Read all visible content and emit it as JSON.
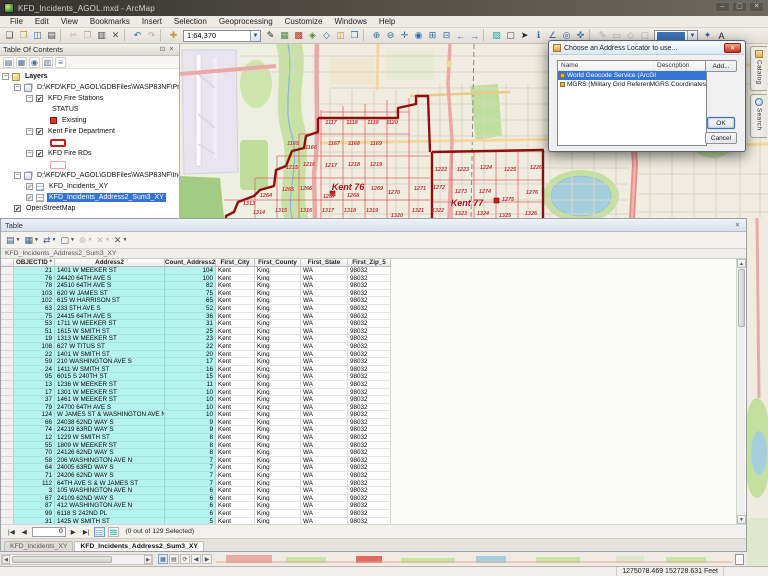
{
  "window": {
    "title": "KFD_Incidents_AGOL.mxd - ArcMap"
  },
  "menu": {
    "items": [
      "File",
      "Edit",
      "View",
      "Bookmarks",
      "Insert",
      "Selection",
      "Geoprocessing",
      "Customize",
      "Windows",
      "Help"
    ]
  },
  "toolbar": {
    "scale": "1:64,370",
    "icons1": [
      {
        "n": "new-map-icon",
        "g": "❏"
      },
      {
        "n": "open-map-icon",
        "g": "❒",
        "c": "y"
      },
      {
        "n": "save-icon",
        "g": "◫",
        "c": "b"
      },
      {
        "n": "print-icon",
        "g": "▤"
      },
      {
        "n": "sep",
        "sep": true
      },
      {
        "n": "cut-icon",
        "g": "✂",
        "c": "x"
      },
      {
        "n": "copy-icon",
        "g": "❐",
        "c": "x"
      },
      {
        "n": "paste-icon",
        "g": "▥"
      },
      {
        "n": "delete-icon",
        "g": "✕"
      },
      {
        "n": "sep",
        "sep": true
      },
      {
        "n": "undo-icon",
        "g": "↶",
        "c": "b"
      },
      {
        "n": "redo-icon",
        "g": "↷",
        "c": "x"
      },
      {
        "n": "sep",
        "sep": true
      },
      {
        "n": "add-data-icon",
        "g": "✚",
        "c": "y"
      }
    ],
    "icons2": [
      {
        "n": "editor-toolbar-icon",
        "g": "✎",
        "c": "k"
      },
      {
        "n": "table-window-icon",
        "g": "▦",
        "c": "g"
      },
      {
        "n": "arctoolbox-icon",
        "g": "▩",
        "c": "r"
      },
      {
        "n": "model-builder-icon",
        "g": "◈",
        "c": "g"
      },
      {
        "n": "python-window-icon",
        "g": "◇",
        "c": "b"
      },
      {
        "n": "catalog-window-icon",
        "g": "◫",
        "c": "y"
      },
      {
        "n": "search-window-icon",
        "g": "❒",
        "c": "b"
      },
      {
        "n": "sep",
        "sep": true
      },
      {
        "n": "zoom-in-icon",
        "g": "⊕",
        "c": "b"
      },
      {
        "n": "zoom-out-icon",
        "g": "⊖",
        "c": "b"
      },
      {
        "n": "pan-icon",
        "g": "✛",
        "c": "b",
        "sel": true
      },
      {
        "n": "full-extent-icon",
        "g": "◉",
        "c": "b"
      },
      {
        "n": "fixed-zoom-in-icon",
        "g": "⊞",
        "c": "b"
      },
      {
        "n": "fixed-zoom-out-icon",
        "g": "⊟",
        "c": "b"
      },
      {
        "n": "go-back-extent-icon",
        "g": "←",
        "c": "b"
      },
      {
        "n": "go-forward-extent-icon",
        "g": "→",
        "c": "b"
      },
      {
        "n": "sep",
        "sep": true
      },
      {
        "n": "select-features-icon",
        "g": "▧",
        "c": "c"
      },
      {
        "n": "clear-selection-icon",
        "g": "▢"
      },
      {
        "n": "select-elements-icon",
        "g": "➤",
        "c": "k"
      },
      {
        "n": "identify-icon",
        "g": "ℹ",
        "c": "b"
      },
      {
        "n": "measure-icon",
        "g": "∠",
        "c": "b"
      },
      {
        "n": "find-icon",
        "g": "◎",
        "c": "b"
      },
      {
        "n": "go-to-xy-icon",
        "g": "✜",
        "c": "b"
      }
    ],
    "icons3": [
      {
        "n": "edit-vertices-icon",
        "g": "✎",
        "c": "x"
      },
      {
        "n": "sketch-properties-icon",
        "g": "▭",
        "c": "x"
      },
      {
        "n": "create-features-icon",
        "g": "◇",
        "c": "x"
      },
      {
        "n": "attributes-icon",
        "g": "▢",
        "c": "x"
      }
    ],
    "icons4": [
      {
        "n": "snapping-icon",
        "g": "✦",
        "c": "b"
      },
      {
        "n": "labeling-icon",
        "g": "A",
        "c": "k"
      }
    ]
  },
  "toc": {
    "title": "Table Of Contents",
    "tools": [
      {
        "n": "list-by-drawing-order-icon",
        "g": "▤"
      },
      {
        "n": "list-by-source-icon",
        "g": "▦"
      },
      {
        "n": "list-by-visibility-icon",
        "g": "◉"
      },
      {
        "n": "list-by-selection-icon",
        "g": "▥"
      },
      {
        "n": "toc-options-icon",
        "g": "≡"
      }
    ],
    "rows": [
      {
        "indent": 0,
        "exp": true,
        "icon": "layers",
        "label": "Layers",
        "bold": true
      },
      {
        "indent": 1,
        "exp": true,
        "icon": "group",
        "label": "D:\\KFD\\KFD_AGOL\\GDBFiles\\WASP83NF\\Protecti"
      },
      {
        "indent": 2,
        "exp": true,
        "check": "on",
        "label": "KFD Fire Stations"
      },
      {
        "indent": 4,
        "label": "STATUS"
      },
      {
        "indent": 4,
        "sym": "point",
        "label": "Existing"
      },
      {
        "indent": 2,
        "exp": true,
        "check": "on",
        "label": "Kent Fire Department"
      },
      {
        "indent": 4,
        "sym": "poly-red",
        "label": ""
      },
      {
        "indent": 2,
        "exp": true,
        "check": "on",
        "label": "KFD Fire RDs"
      },
      {
        "indent": 4,
        "sym": "poly-pink",
        "label": ""
      },
      {
        "indent": 1,
        "exp": true,
        "icon": "group",
        "label": "D:\\KFD\\KFD_AGOL\\GDBFiles\\WASP83NF\\Incident"
      },
      {
        "indent": 2,
        "check": "gray",
        "icon": "tbl",
        "label": "KFD_Incidents_XY"
      },
      {
        "indent": 2,
        "check": "gray",
        "icon": "tbl",
        "label": "KFD_Incidents_Address2_Sum3_XY",
        "sel": true
      },
      {
        "indent": 1,
        "check": "on",
        "label": "OpenStreetMap"
      }
    ]
  },
  "map": {
    "labels": [
      {
        "t": "1117",
        "x": 151,
        "y": 79
      },
      {
        "t": "1118",
        "x": 172,
        "y": 79
      },
      {
        "t": "1119",
        "x": 193,
        "y": 79
      },
      {
        "t": "1120",
        "x": 212,
        "y": 79
      },
      {
        "t": "1165",
        "x": 113,
        "y": 100
      },
      {
        "t": "1166",
        "x": 131,
        "y": 104
      },
      {
        "t": "1167",
        "x": 154,
        "y": 100
      },
      {
        "t": "1168",
        "x": 174,
        "y": 100
      },
      {
        "t": "1169",
        "x": 196,
        "y": 100
      },
      {
        "t": "1215",
        "x": 112,
        "y": 124
      },
      {
        "t": "1216",
        "x": 129,
        "y": 121
      },
      {
        "t": "1217",
        "x": 151,
        "y": 122
      },
      {
        "t": "1218",
        "x": 174,
        "y": 121
      },
      {
        "t": "1219",
        "x": 196,
        "y": 121
      },
      {
        "t": "1222",
        "x": 261,
        "y": 126
      },
      {
        "t": "1223",
        "x": 283,
        "y": 126
      },
      {
        "t": "1224",
        "x": 306,
        "y": 124
      },
      {
        "t": "1225",
        "x": 330,
        "y": 126
      },
      {
        "t": "1226",
        "x": 356,
        "y": 124
      },
      {
        "t": "1264",
        "x": 86,
        "y": 152
      },
      {
        "t": "1265",
        "x": 108,
        "y": 146
      },
      {
        "t": "1266",
        "x": 126,
        "y": 145
      },
      {
        "t": "1267",
        "x": 149,
        "y": 153
      },
      {
        "t": "1268",
        "x": 173,
        "y": 152
      },
      {
        "t": "1269",
        "x": 197,
        "y": 145
      },
      {
        "t": "1270",
        "x": 214,
        "y": 149
      },
      {
        "t": "1271",
        "x": 240,
        "y": 145
      },
      {
        "t": "1272",
        "x": 259,
        "y": 144
      },
      {
        "t": "1273",
        "x": 281,
        "y": 148
      },
      {
        "t": "1274",
        "x": 305,
        "y": 148
      },
      {
        "t": "1275",
        "x": 328,
        "y": 156
      },
      {
        "t": "1276",
        "x": 352,
        "y": 149
      },
      {
        "t": "Kent 76",
        "x": 168,
        "y": 143,
        "big": true
      },
      {
        "t": "Kent 77",
        "x": 287,
        "y": 159,
        "big": true
      },
      {
        "t": "1313",
        "x": 69,
        "y": 160
      },
      {
        "t": "1314",
        "x": 79,
        "y": 169
      },
      {
        "t": "1315",
        "x": 101,
        "y": 167
      },
      {
        "t": "1316",
        "x": 126,
        "y": 167
      },
      {
        "t": "1317",
        "x": 148,
        "y": 167
      },
      {
        "t": "1318",
        "x": 170,
        "y": 167
      },
      {
        "t": "1319",
        "x": 192,
        "y": 167
      },
      {
        "t": "1320",
        "x": 217,
        "y": 172
      },
      {
        "t": "1321",
        "x": 238,
        "y": 167
      },
      {
        "t": "1322",
        "x": 258,
        "y": 167
      },
      {
        "t": "1323",
        "x": 281,
        "y": 170
      },
      {
        "t": "1324",
        "x": 303,
        "y": 170
      },
      {
        "t": "1325",
        "x": 325,
        "y": 172
      },
      {
        "t": "1326",
        "x": 351,
        "y": 170
      }
    ]
  },
  "docktabs": [
    {
      "label": "Catalog"
    },
    {
      "label": "Search"
    }
  ],
  "dialog": {
    "title": "Choose an Address Locator to use...",
    "columns": [
      "Name",
      "Description"
    ],
    "rows": [
      {
        "name": "World Geocode Service (ArcGIS Online)",
        "desc": "",
        "sel": true
      },
      {
        "name": "MGRS (Military Grid Reference System)",
        "desc": "MGRS Coordinates"
      }
    ],
    "buttons": {
      "add": "Add...",
      "ok": "OK",
      "cancel": "Cancel"
    }
  },
  "table": {
    "window_title": "Table",
    "sheet_name": "KFD_Incidents_Address2_Sum3_XY",
    "columns": [
      "OBJECTID *",
      "Address2",
      "Count_Address2",
      "First_City",
      "First_County",
      "First_State",
      "First_Zip_5"
    ],
    "rows": [
      [
        21,
        "1401 W MEEKER ST",
        104,
        "Kent",
        "King",
        "WA",
        "98032"
      ],
      [
        76,
        "24420 64TH AVE S",
        100,
        "Kent",
        "King",
        "WA",
        "98032"
      ],
      [
        78,
        "24510 64TH AVE S",
        82,
        "Kent",
        "King",
        "WA",
        "98032"
      ],
      [
        103,
        "620 W JAMES ST",
        75,
        "Kent",
        "King",
        "WA",
        "98032"
      ],
      [
        102,
        "615 W HARRISON ST",
        65,
        "Kent",
        "King",
        "WA",
        "98032"
      ],
      [
        63,
        "233 5TH AVE S",
        52,
        "Kent",
        "King",
        "WA",
        "98032"
      ],
      [
        75,
        "24415 64TH AVE S",
        36,
        "Kent",
        "King",
        "WA",
        "98032"
      ],
      [
        53,
        "1711 W MEEKER ST",
        31,
        "Kent",
        "King",
        "WA",
        "98032"
      ],
      [
        51,
        "1615 W SMITH ST",
        25,
        "Kent",
        "King",
        "WA",
        "98032"
      ],
      [
        19,
        "1313 W MEEKER ST",
        23,
        "Kent",
        "King",
        "WA",
        "98032"
      ],
      [
        108,
        "627 W TITUS ST",
        22,
        "Kent",
        "King",
        "WA",
        "98032"
      ],
      [
        22,
        "1401 W SMITH ST",
        20,
        "Kent",
        "King",
        "WA",
        "98032"
      ],
      [
        59,
        "210 WASHINGTON AVE S",
        17,
        "Kent",
        "King",
        "WA",
        "98032"
      ],
      [
        24,
        "1411 W SMITH ST",
        16,
        "Kent",
        "King",
        "WA",
        "98032"
      ],
      [
        95,
        "6015 S 240TH ST",
        15,
        "Kent",
        "King",
        "WA",
        "98032"
      ],
      [
        13,
        "1236 W MEEKER ST",
        11,
        "Kent",
        "King",
        "WA",
        "98032"
      ],
      [
        17,
        "1301 W MEEKER ST",
        10,
        "Kent",
        "King",
        "WA",
        "98032"
      ],
      [
        37,
        "1461 W MEEKER ST",
        10,
        "Kent",
        "King",
        "WA",
        "98032"
      ],
      [
        79,
        "24700 64TH AVE S",
        10,
        "Kent",
        "King",
        "WA",
        "98032"
      ],
      [
        124,
        "W JAMES ST & WASHINGTON AVE N",
        10,
        "Kent",
        "King",
        "WA",
        "98032"
      ],
      [
        66,
        "24038 62ND WAY S",
        9,
        "Kent",
        "King",
        "WA",
        "98032"
      ],
      [
        74,
        "24219 63RD WAY S",
        9,
        "Kent",
        "King",
        "WA",
        "98032"
      ],
      [
        12,
        "1229 W SMITH ST",
        8,
        "Kent",
        "King",
        "WA",
        "98032"
      ],
      [
        55,
        "1809 W MEEKER ST",
        8,
        "Kent",
        "King",
        "WA",
        "98032"
      ],
      [
        70,
        "24126 62ND WAY S",
        8,
        "Kent",
        "King",
        "WA",
        "98032"
      ],
      [
        58,
        "206 WASHINGTON AVE N",
        7,
        "Kent",
        "King",
        "WA",
        "98032"
      ],
      [
        64,
        "24005 63RD WAY S",
        7,
        "Kent",
        "King",
        "WA",
        "98032"
      ],
      [
        71,
        "24206 62ND WAY S",
        7,
        "Kent",
        "King",
        "WA",
        "98032"
      ],
      [
        112,
        "64TH AVE S & W JAMES ST",
        7,
        "Kent",
        "King",
        "WA",
        "98032"
      ],
      [
        3,
        "105 WASHINGTON AVE N",
        6,
        "Kent",
        "King",
        "WA",
        "98032"
      ],
      [
        67,
        "24109 62ND WAY S",
        6,
        "Kent",
        "King",
        "WA",
        "98032"
      ],
      [
        87,
        "412 WASHINGTON AVE N",
        6,
        "Kent",
        "King",
        "WA",
        "98032"
      ],
      [
        99,
        "6118 S 242ND PL",
        6,
        "Kent",
        "King",
        "WA",
        "98032"
      ],
      [
        31,
        "1425 W SMITH ST",
        5,
        "Kent",
        "King",
        "WA",
        "98032"
      ]
    ],
    "toolbar_icons": [
      {
        "n": "table-options-icon",
        "g": "▤",
        "dd": true
      },
      {
        "n": "related-tables-icon",
        "g": "▦",
        "dd": true
      },
      {
        "n": "switch-selection-icon",
        "g": "⇄"
      },
      {
        "n": "clear-selection-icon",
        "g": "▢"
      },
      {
        "n": "zoom-to-selected-icon",
        "g": "⊕",
        "gray": true
      },
      {
        "n": "delete-selected-icon",
        "g": "✕",
        "gray": true
      },
      {
        "n": "close-table-icon",
        "g": "✕"
      }
    ],
    "nav": {
      "value": "0",
      "status": "(0 out of 129 Selected)"
    },
    "tabs": [
      {
        "label": "KFD_Incidents_XY"
      },
      {
        "label": "KFD_Incidents_Address2_Sum3_XY",
        "active": true
      }
    ]
  },
  "statusbar": {
    "coords": "1275078.469  152728.631 Feet"
  }
}
